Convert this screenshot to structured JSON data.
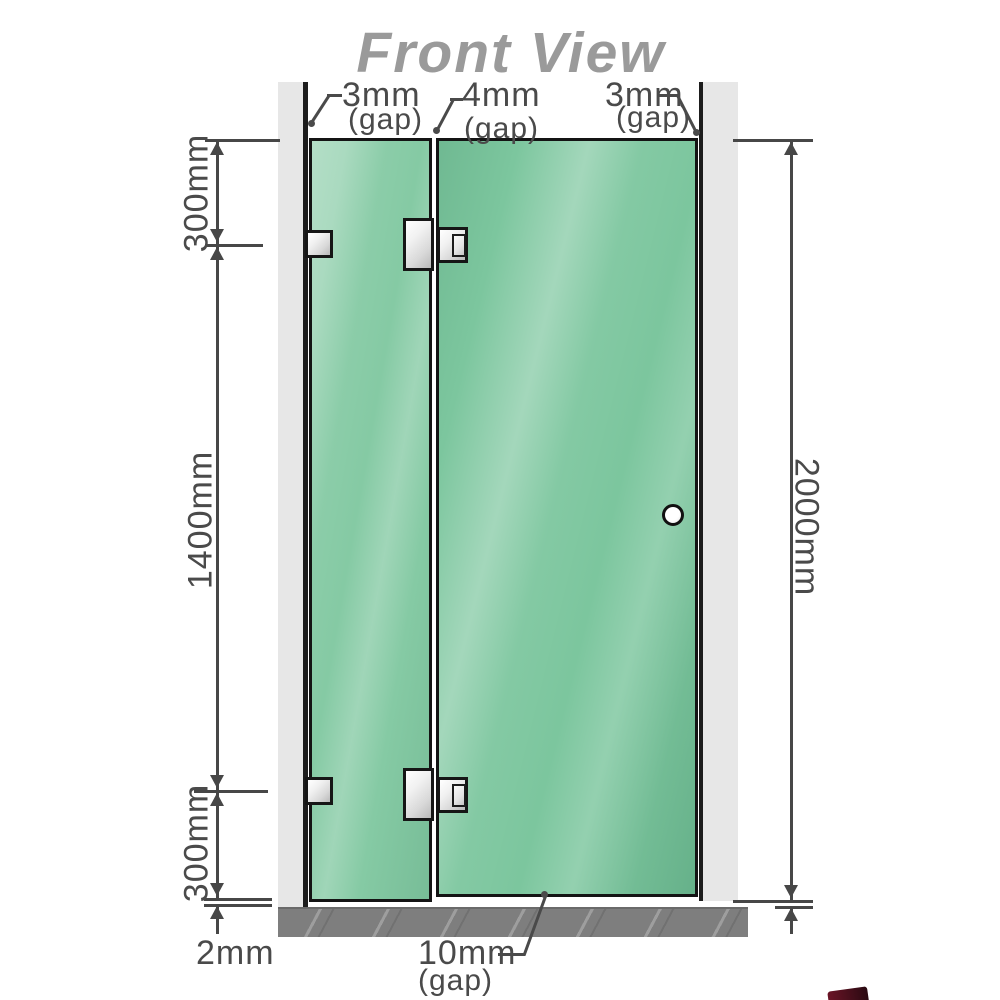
{
  "title": "Front View",
  "gap_labels": {
    "top_left": {
      "value": "3mm",
      "suffix": "(gap)"
    },
    "top_middle": {
      "value": "4mm",
      "suffix": "(gap)"
    },
    "top_right": {
      "value": "3mm",
      "suffix": "(gap)"
    },
    "bottom": {
      "value": "10mm",
      "suffix": "(gap)"
    }
  },
  "dimensions": {
    "left_top": "300mm",
    "left_middle": "1400mm",
    "left_bottom": "300mm",
    "floor_offset": "2mm",
    "right_side": "2000mm"
  },
  "components": {
    "fixed_panel": "glass fixed panel",
    "door_panel": "glass door panel",
    "hinge_count": 2,
    "wall_bracket_count": 2
  },
  "colors": {
    "glass_green": "#85caa4",
    "glass_door_green": "#7cc69e",
    "wall_gray": "#e7e7e7",
    "floor_gray": "#7e7e7e",
    "line_dark": "#474747",
    "text_gray": "#4a4a4a",
    "title_gray": "#9a9a9a",
    "metal_silver": "#d8d8d8",
    "outline_black": "#161616",
    "corner_red": "#5d1122"
  }
}
